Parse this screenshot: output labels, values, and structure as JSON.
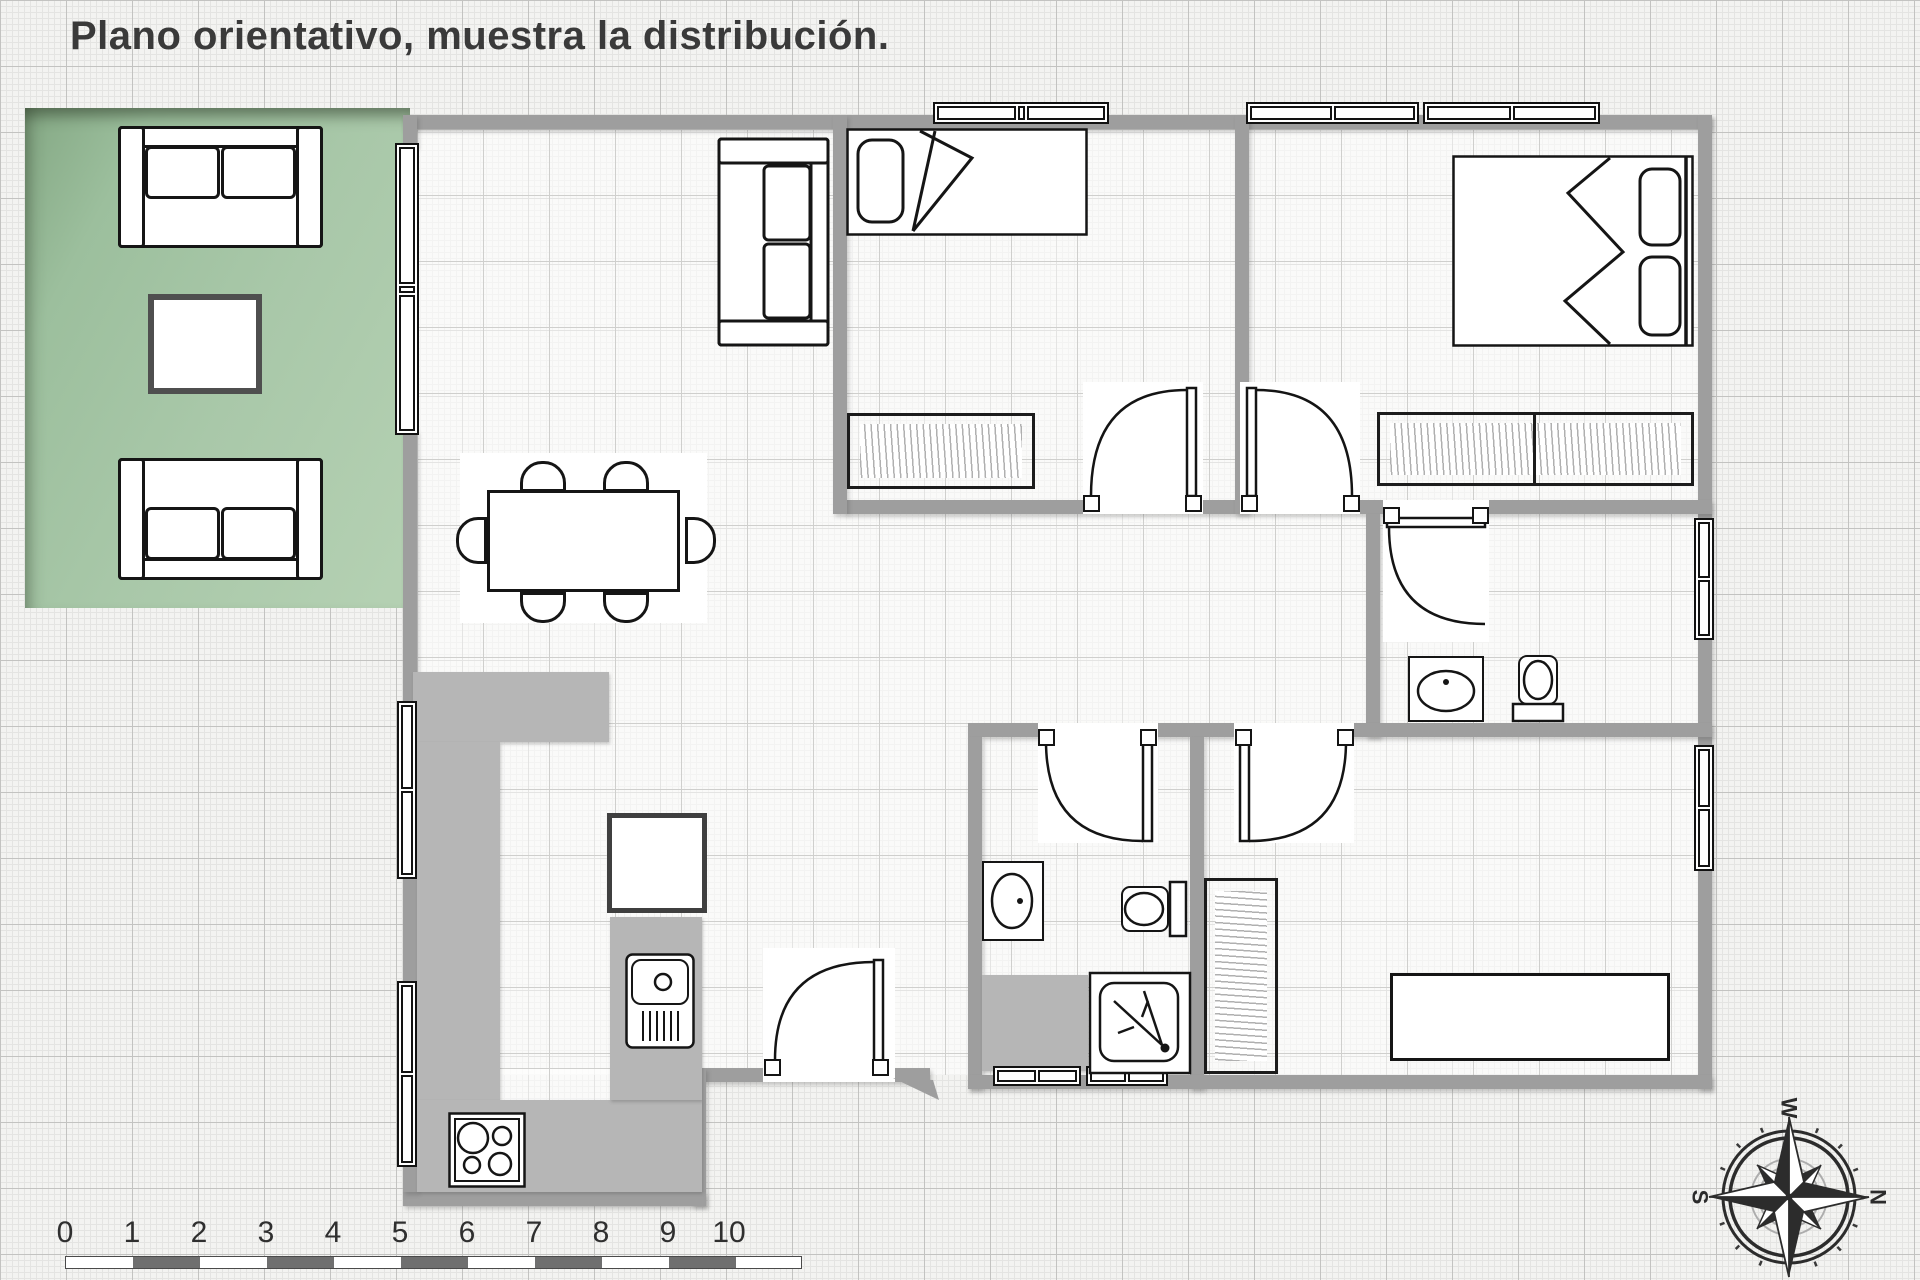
{
  "title": {
    "text": "Plano orientativo, muestra la distribución."
  },
  "scale_bar": {
    "labels": [
      "0",
      "1",
      "2",
      "3",
      "4",
      "5",
      "6",
      "7",
      "8",
      "9",
      "10"
    ]
  },
  "compass": {
    "top": "W",
    "right": "N",
    "bottom": "E",
    "left": "S"
  },
  "colors": {
    "wall": "#9e9e9e",
    "counter": "#b6b6b6",
    "terrace_green": "#a7c6a7",
    "furniture_outline": "#151515",
    "scale_bar_dark": "#6f6f6f",
    "title_text": "#3a3a3a"
  }
}
